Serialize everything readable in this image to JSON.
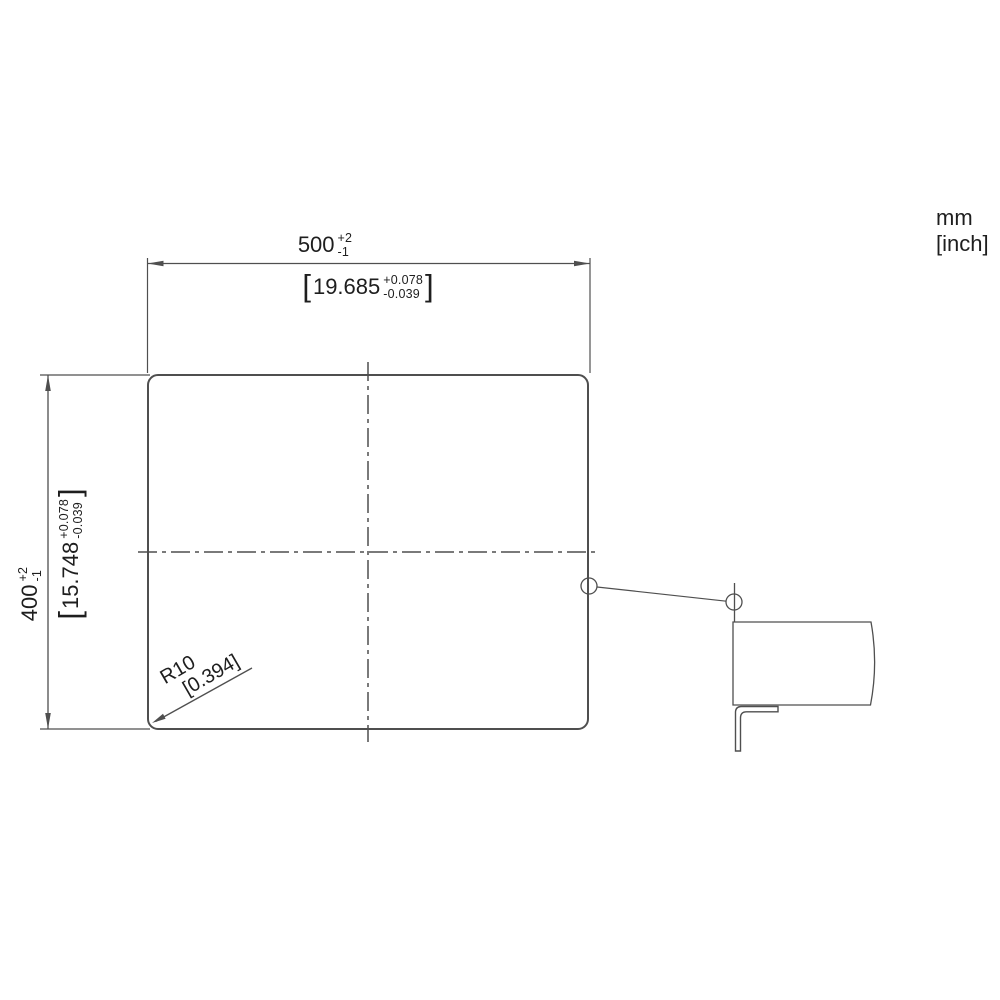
{
  "units_label": {
    "mm": "mm",
    "inch": "[inch]"
  },
  "width_dimension": {
    "mm": "500",
    "mm_tol_upper": "+2",
    "mm_tol_lower": "-1",
    "bracket_open": "[",
    "inch": "19.685",
    "inch_tol_upper": "+0.078",
    "inch_tol_lower": "-0.039",
    "bracket_close": "]"
  },
  "height_dimension": {
    "mm": "400",
    "mm_tol_upper": "+2",
    "mm_tol_lower": "-1",
    "bracket_open": "[",
    "inch": "15.748",
    "inch_tol_upper": "+0.078",
    "inch_tol_lower": "-0.039",
    "bracket_close": "]"
  },
  "corner_radius": {
    "mm": "R10",
    "inch": "[0.394]"
  },
  "colors": {
    "line": "#4f4f4f",
    "text": "#1e1e1e",
    "background": "#ffffff"
  }
}
